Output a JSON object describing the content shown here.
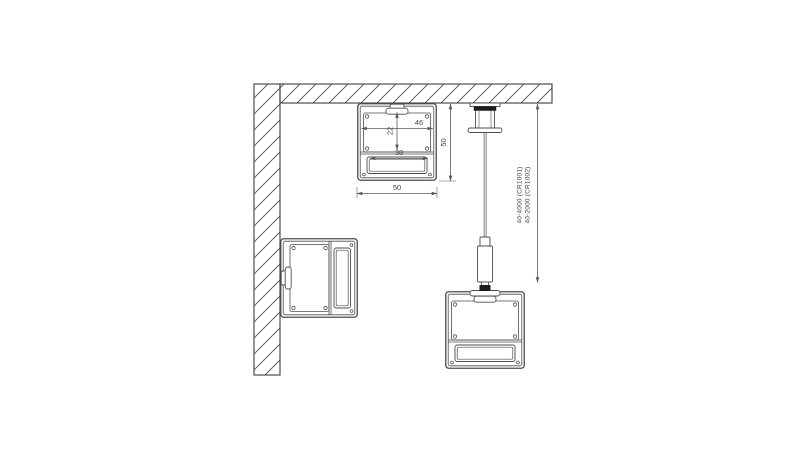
{
  "drawing": {
    "type": "technical-cross-section",
    "labels": {
      "dim_inner_width": "46",
      "dim_inner_height": "22",
      "dim_insert_width": "38",
      "dim_profile_width": "50",
      "dim_profile_height": "50",
      "suspension_code_1": "40-4000 (CR1001)",
      "suspension_code_2": "40-2000 (CR1002)"
    },
    "colors": {
      "line": "#4d4d4d",
      "dimension_line": "#5a5a5a",
      "label_text": "#444444",
      "black_fitting": "#1c1c1c",
      "background": "#ffffff"
    }
  }
}
